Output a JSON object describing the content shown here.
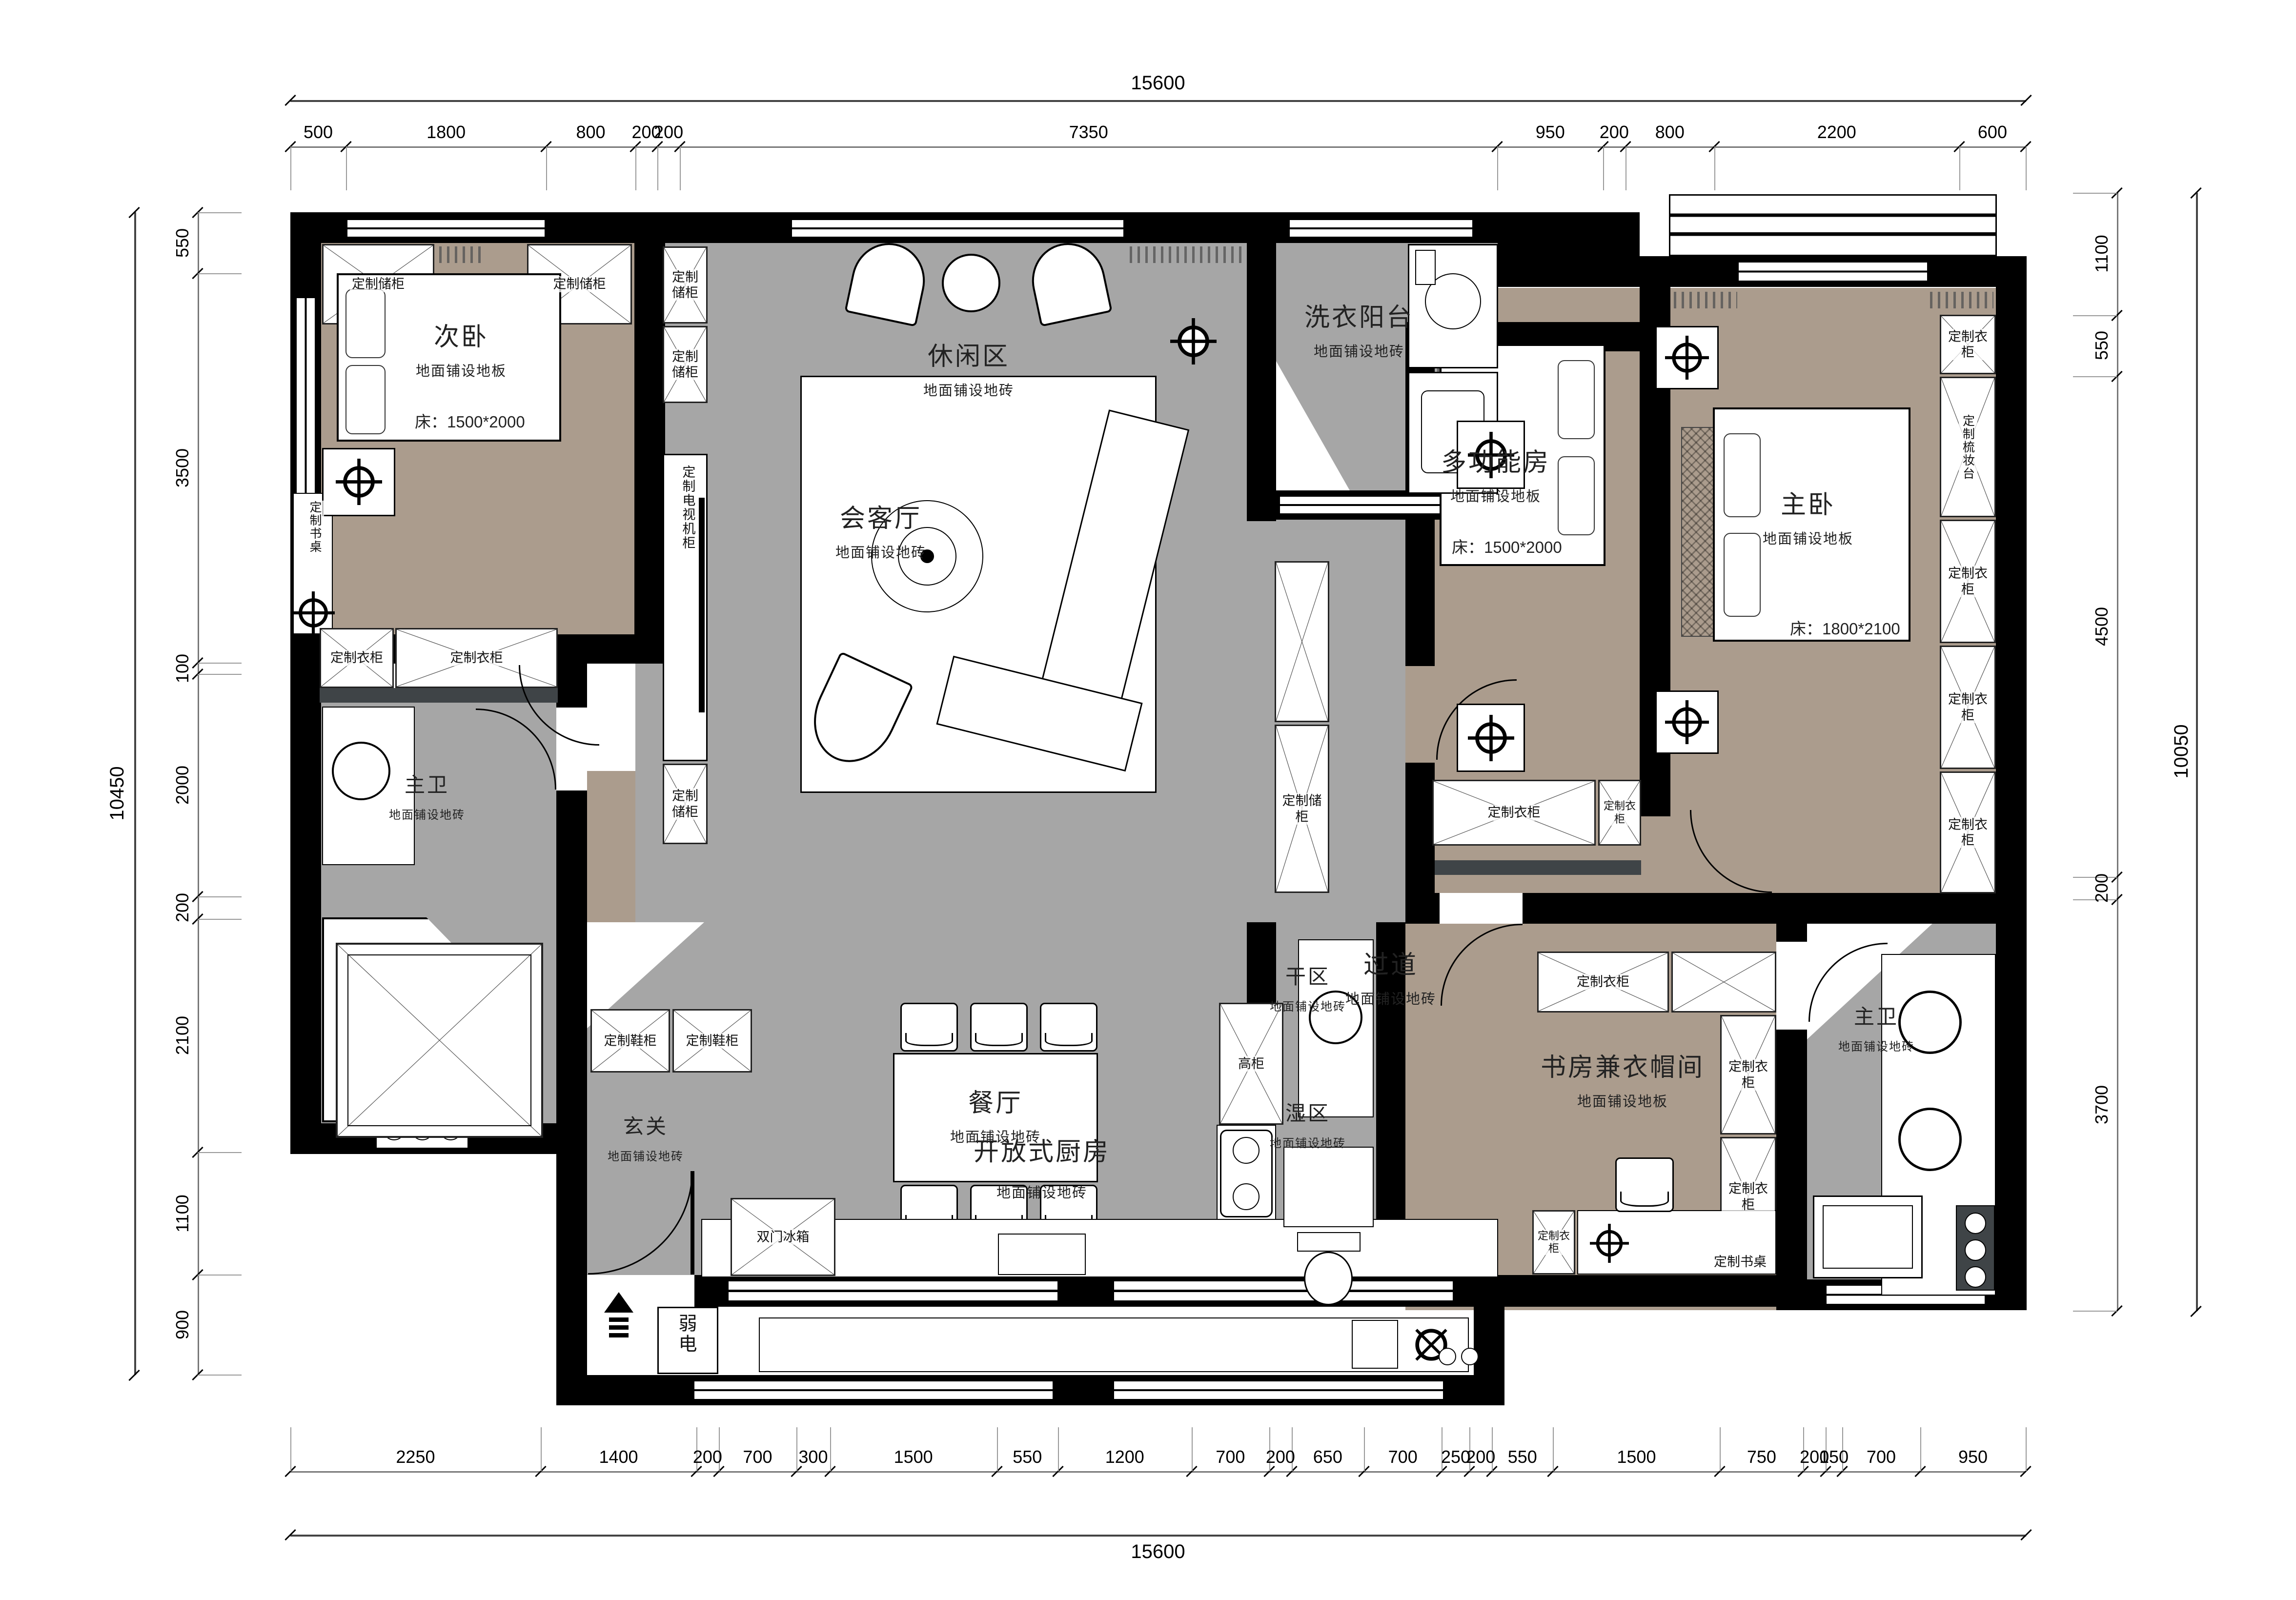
{
  "dimensions": {
    "top": {
      "total": "15600",
      "segments": [
        500,
        1800,
        800,
        200,
        200,
        7350,
        950,
        200,
        800,
        2200,
        600
      ]
    },
    "bottom": {
      "total": "15600",
      "segments": [
        2250,
        1400,
        200,
        700,
        300,
        1500,
        550,
        1200,
        700,
        200,
        650,
        700,
        250,
        200,
        550,
        1500,
        750,
        200,
        150,
        700,
        950
      ]
    },
    "left": {
      "total": "10450",
      "segments": [
        550,
        3500,
        100,
        2000,
        200,
        2100,
        1100,
        900
      ]
    },
    "right": {
      "total": "10050",
      "segments": [
        1100,
        550,
        4500,
        200,
        3700
      ]
    }
  },
  "rooms": {
    "secondary_bedroom": {
      "name": "次卧",
      "floor": "地面铺设地板",
      "bed": "床：1500*2000"
    },
    "leisure": {
      "name": "休闲区",
      "floor": "地面铺设地砖"
    },
    "laundry_balcony": {
      "name": "洗衣阳台",
      "floor": "地面铺设地砖"
    },
    "living": {
      "name": "会客厅",
      "floor": "地面铺设地砖"
    },
    "multi_room": {
      "name": "多功能房",
      "floor": "地面铺设地板",
      "bed": "床：1500*2000"
    },
    "master_bedroom": {
      "name": "主卧",
      "floor": "地面铺设地板",
      "bed": "床：1800*2100"
    },
    "master_bath_left": {
      "name": "主卫",
      "floor": "地面铺设地砖"
    },
    "corridor": {
      "name": "过道",
      "floor": "地面铺设地砖"
    },
    "dining": {
      "name": "餐厅",
      "floor": "地面铺设地砖"
    },
    "entry": {
      "name": "玄关",
      "floor": "地面铺设地砖"
    },
    "open_kitchen": {
      "name": "开放式厨房",
      "floor": "地面铺设地砖"
    },
    "dry_zone": {
      "name": "干区",
      "floor": "地面铺设地砖"
    },
    "wet_zone": {
      "name": "湿区",
      "floor": "地面铺设地砖"
    },
    "study_cloakroom": {
      "name": "书房兼衣帽间",
      "floor": "地面铺设地板"
    },
    "master_bath_right": {
      "name": "主卫",
      "floor": "地面铺设地砖"
    },
    "weak_current": {
      "name": "弱电"
    }
  },
  "fixtures": {
    "storage": "定制储柜",
    "wardrobe": "定制衣柜",
    "desk": "定制书桌",
    "tv_cabinet": "定制电视机柜",
    "shoe_cabinet": "定制鞋柜",
    "dresser": "定制梳妆台",
    "tall_cabinet": "高柜",
    "fridge": "双门冰箱"
  },
  "colors": {
    "wall": "#000000",
    "tile_floor": "#a6a6a6",
    "wood_floor": "#ab9c8d",
    "sill": "#3f4447"
  }
}
